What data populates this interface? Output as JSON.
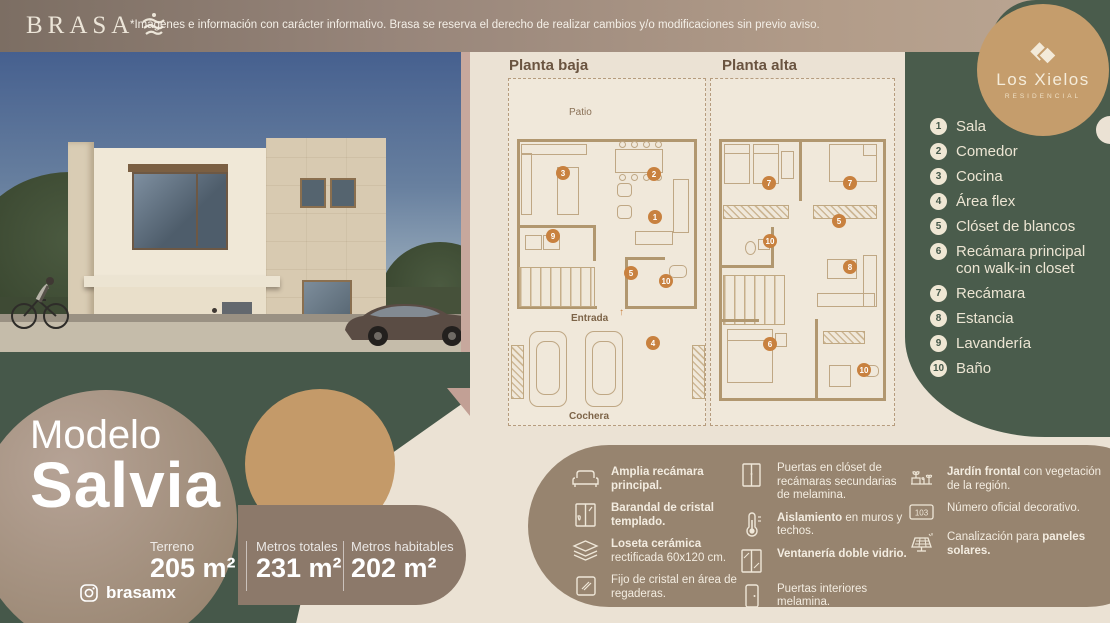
{
  "topbar": {
    "brand": "BRASA",
    "disclaimer": "*Imágenes e información con carácter informativo. Brasa se reserva el derecho de realizar cambios y/o modificaciones sin previo aviso."
  },
  "logo_badge": {
    "name": "Los Xielos",
    "subtitle": "RESIDENCIAL"
  },
  "colors": {
    "green": "#4a5c4c",
    "tan": "#c59d6c",
    "cream": "#ebe2d4",
    "taupe": "#97846f",
    "badge_orange": "#c8813f"
  },
  "plans": {
    "baja": {
      "title": "Planta baja",
      "patio": "Patio",
      "entrada": "Entrada",
      "cochera": "Cochera",
      "badges": [
        3,
        2,
        1,
        9,
        5,
        10,
        4
      ]
    },
    "alta": {
      "title": "Planta alta",
      "badges": [
        7,
        7,
        5,
        10,
        8,
        6,
        10
      ]
    }
  },
  "legend": {
    "items": [
      {
        "num": "1",
        "label": "Sala"
      },
      {
        "num": "2",
        "label": "Comedor"
      },
      {
        "num": "3",
        "label": "Cocina"
      },
      {
        "num": "4",
        "label": "Área flex"
      },
      {
        "num": "5",
        "label": "Clóset de blancos"
      },
      {
        "num": "6",
        "label": "Recámara principal con walk-in closet"
      },
      {
        "num": "7",
        "label": "Recámara"
      },
      {
        "num": "8",
        "label": "Estancia"
      },
      {
        "num": "9",
        "label": "Lavandería"
      },
      {
        "num": "10",
        "label": "Baño"
      }
    ]
  },
  "model": {
    "prefix": "Modelo",
    "name": "Salvia"
  },
  "stats": [
    {
      "label": "Terreno",
      "value": "205 m²"
    },
    {
      "label": "Metros totales",
      "value": "231 m²"
    },
    {
      "label": "Metros habitables",
      "value": "202 m²"
    }
  ],
  "social": {
    "handle": "brasamx"
  },
  "features": {
    "col1": [
      {
        "pre": "",
        "bold": "Amplia recámara principal.",
        "rest": ""
      },
      {
        "pre": "",
        "bold": "Barandal de cristal templado.",
        "rest": ""
      },
      {
        "pre": "",
        "bold": "Loseta cerámica",
        "rest": " rectificada 60x120 cm."
      },
      {
        "pre": "Fijo de cristal en área de regaderas.",
        "bold": "",
        "rest": ""
      }
    ],
    "col2": [
      {
        "pre": "Puertas en clóset de recámaras secundarias de melamina.",
        "bold": "",
        "rest": ""
      },
      {
        "pre": "",
        "bold": "Aislamiento",
        "rest": " en muros y techos."
      },
      {
        "pre": "",
        "bold": "Ventanería doble vidrio.",
        "rest": ""
      },
      {
        "pre": "Puertas interiores melamina.",
        "bold": "",
        "rest": ""
      }
    ],
    "col3": [
      {
        "pre": "",
        "bold": "Jardín frontal",
        "rest": " con vegetación de la región."
      },
      {
        "pre": "Número oficial decorativo.",
        "bold": "",
        "rest": ""
      },
      {
        "pre": "Canalización para ",
        "bold": "paneles solares.",
        "rest": ""
      }
    ],
    "plate_number": "103"
  }
}
